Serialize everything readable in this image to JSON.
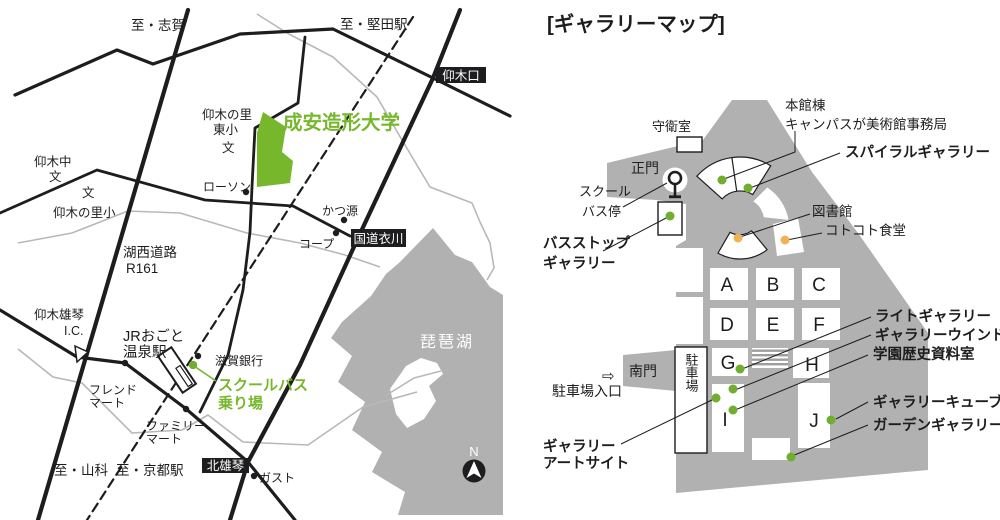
{
  "title": "[ギャラリーマップ]",
  "colors": {
    "green": "#77b72c",
    "campus_gray": "#b1b1b1",
    "orange_dot": "#f1b156",
    "green_dot": "#6fae2f",
    "road_black": "#1d1d1f"
  },
  "access_map": {
    "university_name": "成安造形大学",
    "destinations": {
      "shiga": "至・志賀",
      "katata": "至・堅田駅",
      "yamashina": "至・山科",
      "kyoto": "至・京都駅"
    },
    "road_signs": {
      "ogiguchi": "仰木口",
      "kokudo_kinugawa": "国道衣川",
      "kitaogoto": "北雄琴"
    },
    "roads": {
      "kosei": "湖西道路",
      "r161": "R161"
    },
    "interchange": {
      "line1": "仰木雄琴",
      "line2": "I.C."
    },
    "station": {
      "line1": "JRおごと",
      "line2": "温泉駅"
    },
    "schools": {
      "ogi_east_1": "仰木の里",
      "ogi_east_2": "東小",
      "ogi_east_mark": "文",
      "ogi_jhs": "仰木中",
      "ogi_jhs_mark": "文",
      "ogi_elem_mark": "文",
      "ogi_elem": "仰木の里小"
    },
    "landmarks": {
      "lawson": "ローソン",
      "katsugen": "かつ源",
      "coop": "コープ",
      "shiga_bank": "滋賀銀行",
      "friend_mart_1": "フレンド",
      "friend_mart_2": "マート",
      "family_mart_1": "ファミリー",
      "family_mart_2": "マート",
      "gusto": "ガスト"
    },
    "school_bus": {
      "line1": "スクールバス",
      "line2": "乗り場"
    },
    "lake": "琵琶湖",
    "compass_n": "N"
  },
  "gallery_map": {
    "labels": {
      "guard_room": "守衛室",
      "main_gate": "正門",
      "school_bus_1": "スクール",
      "school_bus_2": "バス停",
      "honkan_1": "本館棟",
      "honkan_2": "キャンパスが美術館事務局",
      "library": "図書館",
      "cafeteria": "コトコト食堂",
      "south_gate": "南門",
      "parking_entrance": "駐車場入口",
      "parking_arrow": "⇨",
      "parking": "駐車場"
    },
    "galleries": {
      "spiral": "スパイラルギャラリー",
      "bus_stop_1": "バスストップ",
      "bus_stop_2": "ギャラリー",
      "light": "ライトギャラリー",
      "window": "ギャラリーウインドウ",
      "history": "学園歴史資料室",
      "cube": "ギャラリーキューブ",
      "garden": "ガーデンギャラリー",
      "art_site_1": "ギャラリー",
      "art_site_2": "アートサイト"
    },
    "buildings": [
      "A",
      "B",
      "C",
      "D",
      "E",
      "F",
      "G",
      "H",
      "I",
      "J"
    ]
  }
}
